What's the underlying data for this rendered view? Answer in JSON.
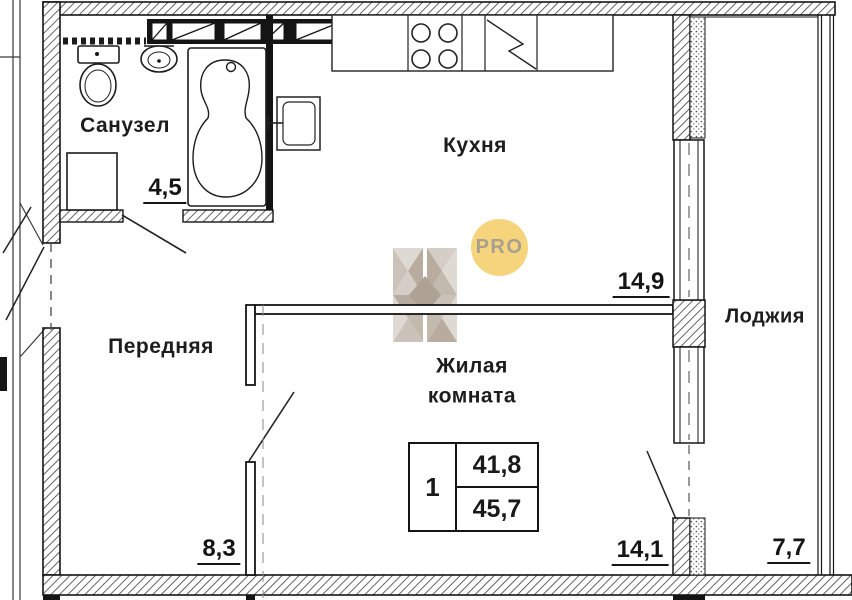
{
  "plan_title": "apartment-floor-plan",
  "rooms": {
    "bathroom": {
      "label": "Санузел",
      "area": "4,5"
    },
    "kitchen": {
      "label": "Кухня",
      "area": "14,9"
    },
    "hall": {
      "label": "Передняя",
      "area": "8,3"
    },
    "living": {
      "label": "Жилая комната",
      "area": "14,1"
    },
    "loggia": {
      "label": "Лоджия",
      "area": "7,7"
    }
  },
  "info_table": {
    "rooms_count": "1",
    "area_top": "41,8",
    "area_bottom": "45,7"
  },
  "watermark": {
    "badge_text": "PRO"
  },
  "colors": {
    "line": "#151515",
    "watermark_badge": "#f6d47c",
    "watermark_badge_text": "#a89f90",
    "watermark_facet_light": "#ddd7d0",
    "watermark_facet_mid": "#c8bfb4",
    "watermark_facet_dark": "#b2a697"
  }
}
